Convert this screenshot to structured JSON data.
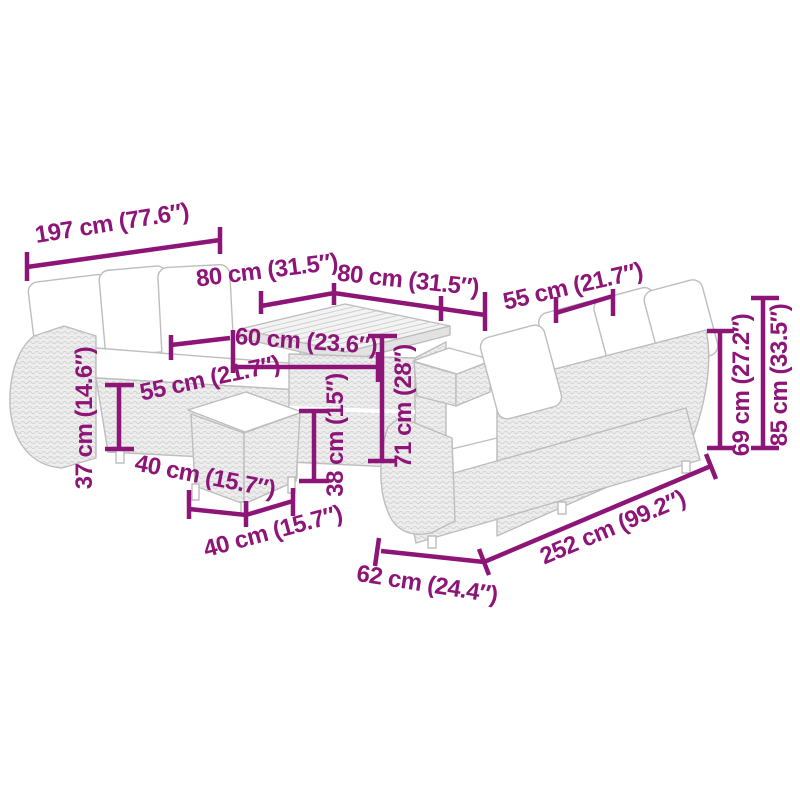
{
  "diagram": {
    "accent_color": "#8E1578",
    "furniture_outline_color": "#bdbdbd",
    "background_color": "#ffffff",
    "dimensions": {
      "left_sofa_length": "197 cm (77.6″)",
      "table_top_width": "80 cm (31.5″)",
      "table_top_depth": "80 cm (31.5″)",
      "table_base_width": "60 cm (23.6″)",
      "left_sofa_seat_depth": "55 cm (21.7″)",
      "left_sofa_seat_height": "37 cm (14.6″)",
      "stool_depth": "40 cm (15.7″)",
      "stool_width": "40 cm (15.7″)",
      "stool_height": "38 cm (15″)",
      "table_height": "71 cm (28″)",
      "right_sofa_seat_depth": "55 cm (21.7″)",
      "right_sofa_back_height": "69 cm (27.2″)",
      "right_sofa_total_height": "85 cm (33.5″)",
      "right_sofa_length": "252 cm (99.2″)",
      "right_sofa_depth": "62 cm (24.4″)"
    }
  }
}
